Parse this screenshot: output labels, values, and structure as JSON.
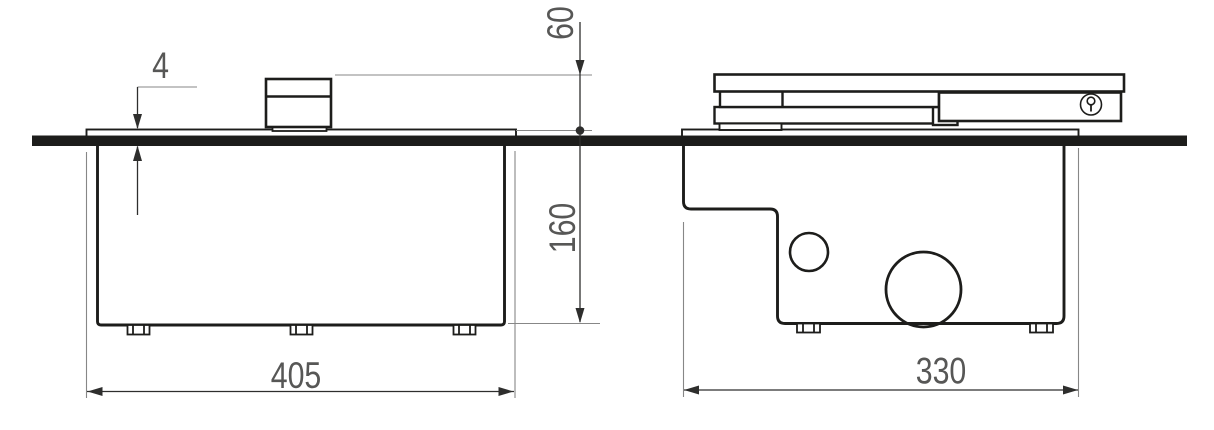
{
  "drawing": {
    "type": "technical-dimension-drawing",
    "dimensions": {
      "lid_protrusion": "4",
      "height_above_floor": "60",
      "depth_below_floor": "160",
      "side_view_width": "405",
      "front_view_width": "330"
    },
    "icons": {
      "lock": "keyhole-icon"
    },
    "colors": {
      "line": "#1d1d1b",
      "dim_line": "#2e2e2d",
      "ext_line": "#878787",
      "dim_text": "#575756",
      "background": "#ffffff"
    }
  }
}
